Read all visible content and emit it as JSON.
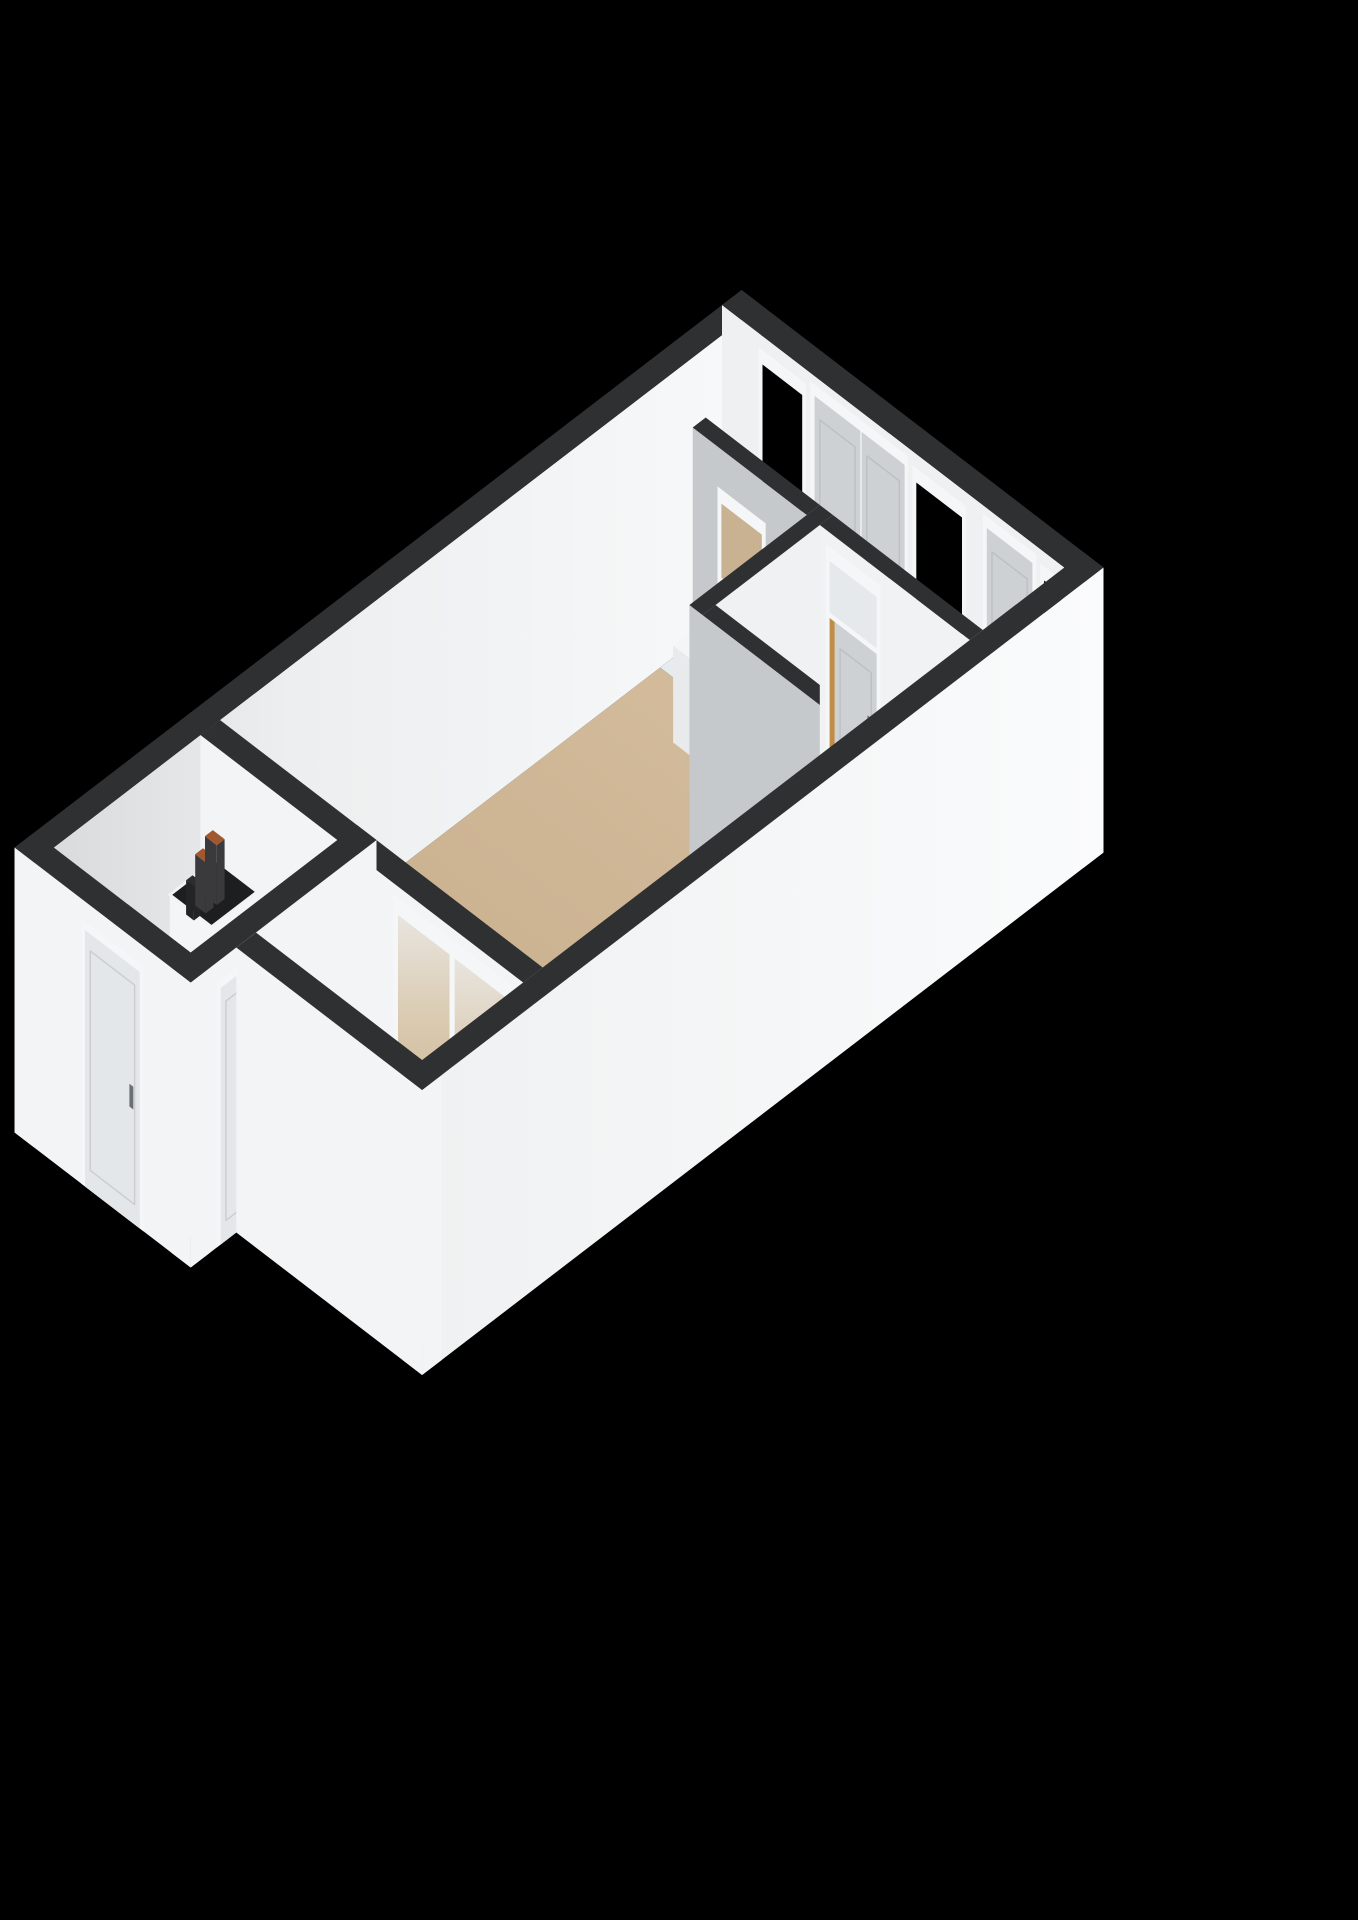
{
  "scene": {
    "type": "3d-floorplan-isometric-render",
    "background": "#000000",
    "rooms": [
      {
        "id": "living-room",
        "floor_color_key": "floor_living"
      },
      {
        "id": "kitchen",
        "floor_color_key": "floor_kitchen"
      },
      {
        "id": "corridor",
        "floor_color_key": "floor_wood"
      },
      {
        "id": "bathroom",
        "floor_color_key": "floor_bathroom"
      },
      {
        "id": "hallway",
        "floor_color_key": "floor_hall"
      },
      {
        "id": "balcony",
        "floor_color_key": "floor_balcony"
      }
    ],
    "features": [
      "exterior-window",
      "french-double-doors",
      "single-exterior-door",
      "kitchen-counter-black-top",
      "sideboard-cabinet",
      "bathroom-door-with-transom",
      "partition-interior-window",
      "utility-meter-box",
      "front-door",
      "hall-balcony-door",
      "large-balcony-window",
      "balcony-tiled-floor",
      "window-sill-ledge"
    ]
  },
  "palette": {
    "background": "#000000",
    "wall_top": "#2f3032",
    "wall_white": "#f3f4f5",
    "wall_interior": "#eef0f2",
    "wall_grey": "#c6c9cc",
    "wall_grey_light": "#d4d7d9",
    "floor_living": "#cdb493",
    "floor_kitchen": "#e6ebf0",
    "floor_wood": "#bf8d49",
    "floor_hall": "#f0f1f1",
    "floor_balcony": "#e7e9e9",
    "balcony_grout": "#d8dbdb",
    "floor_bathroom": "#eff0f0",
    "door_leaf": "#cdd1d4",
    "door_leaf_light": "#e4e7e9",
    "door_frame": "#f4f6f7",
    "glass_dark": "#000000",
    "glass_light": "#e6e9eb",
    "glass_tan": "#c9b291",
    "counter_body": "#eceded",
    "counter_side": "#dfe2e4",
    "cabinet_white": "#f4f5f6",
    "cabinet_side": "#e9eaeb",
    "cabinet_front": "#eef0f1",
    "handle": "#6a6f73",
    "pipe_dark": "#3a3a3c",
    "pipe_copper": "#a2572e",
    "tech_opening": "#1d1e20",
    "bathroom_inner": "#f0f1f2"
  }
}
